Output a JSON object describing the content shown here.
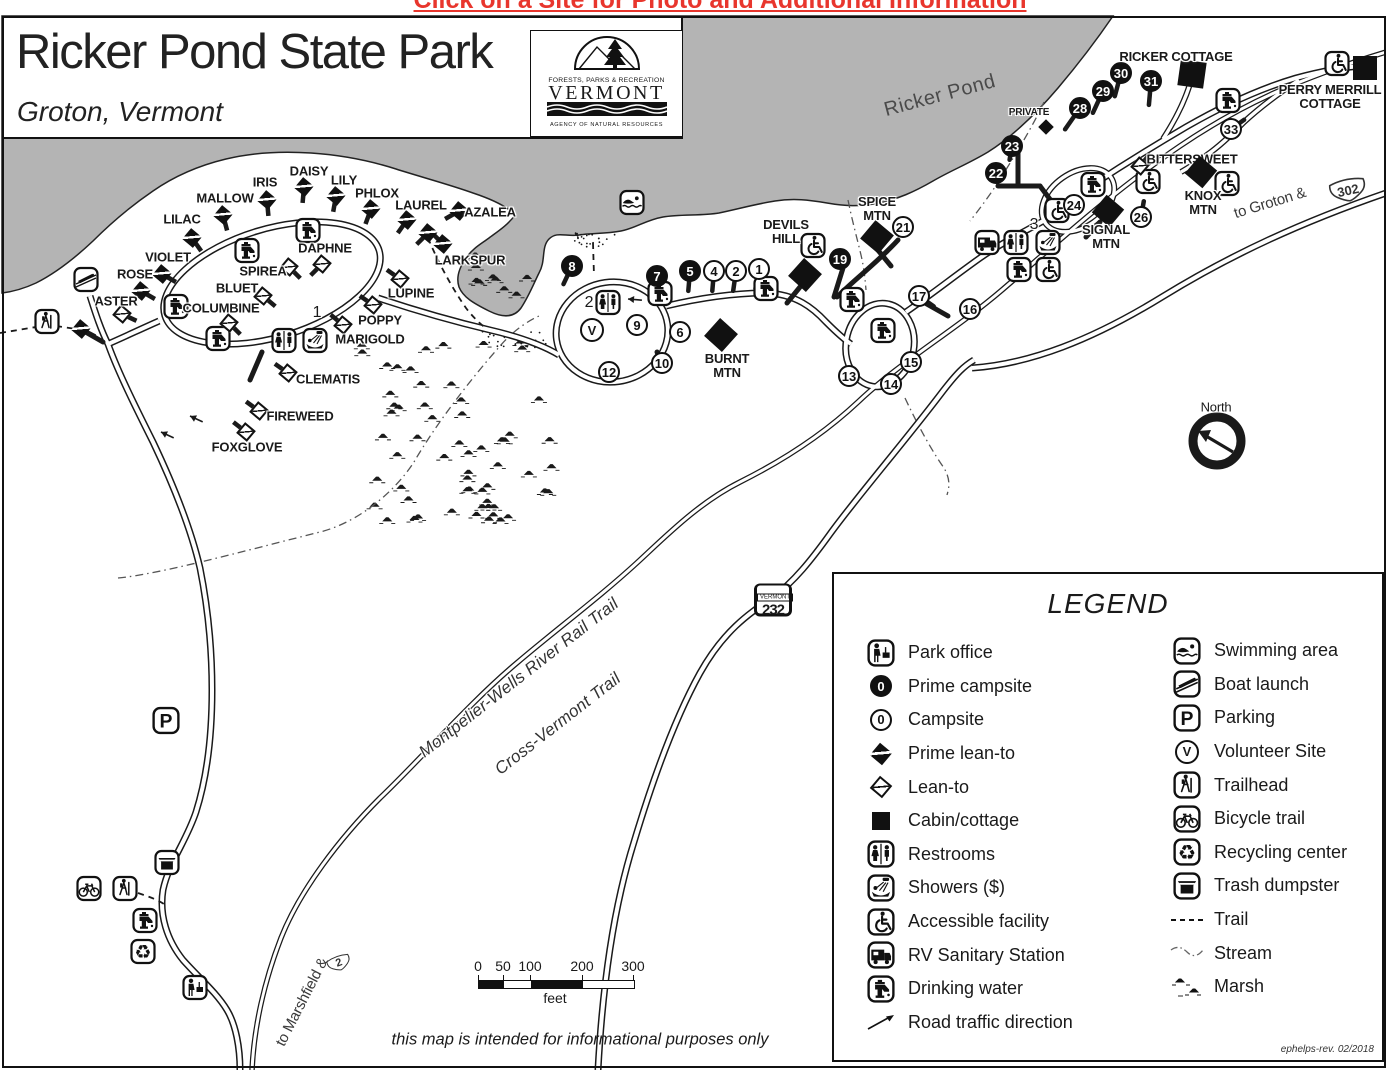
{
  "page": {
    "top_note": "Click on a Site for Photo and Additional Information"
  },
  "title_block": {
    "title": "Ricker Pond State Park",
    "subtitle": "Groton, Vermont",
    "logo": {
      "line1": "FORESTS, PARKS & RECREATION",
      "line2": "VERMONT",
      "line3": "AGENCY OF NATURAL RESOURCES"
    }
  },
  "map": {
    "water_label": "Ricker Pond",
    "north_label": "North",
    "trail_labels": [
      {
        "text": "Montpelier-Wells River Rail Trail",
        "x": 519,
        "y": 678,
        "rot": -38
      },
      {
        "text": "Cross-Vermont Trail",
        "x": 558,
        "y": 724,
        "rot": -38
      }
    ],
    "road_labels": [
      {
        "text": "to Groton &",
        "x": 1270,
        "y": 203,
        "rot": -17
      },
      {
        "text": "to Marshfield &",
        "x": 302,
        "y": 1002,
        "rot": -63
      }
    ],
    "shields": [
      {
        "kind": "vt",
        "topline": "VERMONT",
        "num": "232",
        "x": 773,
        "y": 600,
        "rot": 0
      },
      {
        "kind": "us",
        "num": "302",
        "x": 1348,
        "y": 190,
        "rot": -12
      },
      {
        "kind": "us",
        "num": "2",
        "x": 339,
        "y": 963,
        "rot": -20
      }
    ],
    "campsites": [
      {
        "n": "1",
        "x": 759,
        "y": 269,
        "prime": false
      },
      {
        "n": "2",
        "x": 736,
        "y": 271,
        "prime": false
      },
      {
        "n": "4",
        "x": 714,
        "y": 271,
        "prime": false
      },
      {
        "n": "5",
        "x": 690,
        "y": 271,
        "prime": true
      },
      {
        "n": "7",
        "x": 657,
        "y": 276,
        "prime": true
      },
      {
        "n": "8",
        "x": 572,
        "y": 266,
        "prime": true
      },
      {
        "n": "6",
        "x": 680,
        "y": 332,
        "prime": false
      },
      {
        "n": "9",
        "x": 637,
        "y": 325,
        "prime": false
      },
      {
        "n": "10",
        "x": 662,
        "y": 363,
        "prime": false
      },
      {
        "n": "12",
        "x": 609,
        "y": 372,
        "prime": false
      },
      {
        "n": "13",
        "x": 849,
        "y": 376,
        "prime": false
      },
      {
        "n": "14",
        "x": 891,
        "y": 384,
        "prime": false
      },
      {
        "n": "15",
        "x": 911,
        "y": 362,
        "prime": false
      },
      {
        "n": "16",
        "x": 970,
        "y": 309,
        "prime": false
      },
      {
        "n": "17",
        "x": 919,
        "y": 296,
        "prime": false
      },
      {
        "n": "19",
        "x": 840,
        "y": 259,
        "prime": true
      },
      {
        "n": "21",
        "x": 903,
        "y": 227,
        "prime": false
      },
      {
        "n": "22",
        "x": 996,
        "y": 173,
        "prime": true
      },
      {
        "n": "23",
        "x": 1012,
        "y": 146,
        "prime": true
      },
      {
        "n": "24",
        "x": 1074,
        "y": 205,
        "prime": false
      },
      {
        "n": "26",
        "x": 1141,
        "y": 217,
        "prime": false
      },
      {
        "n": "28",
        "x": 1080,
        "y": 108,
        "prime": true
      },
      {
        "n": "29",
        "x": 1103,
        "y": 91,
        "prime": true
      },
      {
        "n": "30",
        "x": 1121,
        "y": 73,
        "prime": true
      },
      {
        "n": "31",
        "x": 1151,
        "y": 81,
        "prime": true
      },
      {
        "n": "33",
        "x": 1231,
        "y": 129,
        "prime": false
      }
    ],
    "area_labels": [
      {
        "text": "1",
        "x": 317,
        "y": 313
      },
      {
        "text": "2",
        "x": 589,
        "y": 303
      },
      {
        "text": "3",
        "x": 1034,
        "y": 225
      }
    ],
    "leantos": [
      {
        "name": "LILAC",
        "ix": 192,
        "iy": 238,
        "lx": 182,
        "ly": 219,
        "prime": true,
        "spur": 55
      },
      {
        "name": "MALLOW",
        "ix": 223,
        "iy": 215,
        "lx": 225,
        "ly": 198,
        "prime": true,
        "spur": 75
      },
      {
        "name": "IRIS",
        "ix": 267,
        "iy": 200,
        "lx": 265,
        "ly": 182,
        "prime": true,
        "spur": 85
      },
      {
        "name": "DAISY",
        "ix": 304,
        "iy": 187,
        "lx": 309,
        "ly": 171,
        "prime": true,
        "spur": 95
      },
      {
        "name": "LILY",
        "ix": 336,
        "iy": 196,
        "lx": 344,
        "ly": 180,
        "prime": true,
        "spur": 100
      },
      {
        "name": "PHLOX",
        "ix": 371,
        "iy": 209,
        "lx": 377,
        "ly": 193,
        "prime": true,
        "spur": 110
      },
      {
        "name": "LAUREL",
        "ix": 407,
        "iy": 220,
        "lx": 421,
        "ly": 205,
        "prime": true,
        "spur": 125
      },
      {
        "name": "",
        "ix": 428,
        "iy": 233,
        "lx": 0,
        "ly": 0,
        "prime": true,
        "spur": 135
      },
      {
        "name": "AZALEA",
        "ix": 459,
        "iy": 211,
        "lx": 490,
        "ly": 212,
        "prime": true,
        "spur": 150
      },
      {
        "name": "LARKSPUR",
        "ix": 443,
        "iy": 244,
        "lx": 470,
        "ly": 260,
        "prime": true,
        "spur": 225
      },
      {
        "name": "VIOLET",
        "ix": 162,
        "iy": 274,
        "lx": 168,
        "ly": 257,
        "prime": true,
        "spur": 30
      },
      {
        "name": "ROSE",
        "ix": 141,
        "iy": 291,
        "lx": 135,
        "ly": 274,
        "prime": true,
        "spur": 30
      },
      {
        "name": "ASTER",
        "ix": 122,
        "iy": 314,
        "lx": 116,
        "ly": 301,
        "prime": false,
        "spur": 25
      },
      {
        "name": "",
        "ix": 81,
        "iy": 329,
        "lx": 0,
        "ly": 0,
        "prime": true,
        "spur": 28
      },
      {
        "name": "DAPHNE",
        "ix": 322,
        "iy": 264,
        "lx": 325,
        "ly": 248,
        "prime": false,
        "spur": 135
      },
      {
        "name": "SPIREA",
        "ix": 289,
        "iy": 267,
        "lx": 263,
        "ly": 271,
        "prime": false,
        "spur": 45
      },
      {
        "name": "BLUET",
        "ix": 263,
        "iy": 296,
        "lx": 237,
        "ly": 288,
        "prime": false,
        "spur": 40
      },
      {
        "name": "COLUMBINE",
        "ix": 229,
        "iy": 323,
        "lx": 221,
        "ly": 308,
        "prime": false,
        "spur": 45
      },
      {
        "name": "LUPINE",
        "ix": 400,
        "iy": 279,
        "lx": 411,
        "ly": 293,
        "prime": false,
        "spur": 215
      },
      {
        "name": "POPPY",
        "ix": 373,
        "iy": 305,
        "lx": 380,
        "ly": 320,
        "prime": false,
        "spur": 215
      },
      {
        "name": "MARIGOLD",
        "ix": 343,
        "iy": 325,
        "lx": 370,
        "ly": 339,
        "prime": false,
        "spur": 220
      },
      {
        "name": "CLEMATIS",
        "ix": 288,
        "iy": 373,
        "lx": 328,
        "ly": 379,
        "prime": false,
        "spur": 215
      },
      {
        "name": "FIREWEED",
        "ix": 259,
        "iy": 411,
        "lx": 300,
        "ly": 416,
        "prime": false,
        "spur": 216
      },
      {
        "name": "FOXGLOVE",
        "ix": 246,
        "iy": 432,
        "lx": 247,
        "ly": 447,
        "prime": false,
        "spur": 218
      },
      {
        "name": "BITTERSWEET",
        "ix": 1140,
        "iy": 166,
        "lx": 1192,
        "ly": 159,
        "prime": false,
        "spur": 310
      }
    ],
    "cabins": [
      {
        "name": "RICKER COTTAGE",
        "lines": [
          "RICKER COTTAGE"
        ],
        "sx": 1192,
        "sy": 74,
        "size": 26,
        "rot": 8,
        "lx": 1176,
        "ly": 57
      },
      {
        "name": "PERRY MERRILL COTTAGE",
        "lines": [
          "PERRY MERRILL",
          "COTTAGE"
        ],
        "sx": 1365,
        "sy": 68,
        "size": 24,
        "rot": 0,
        "lx": 1330,
        "ly": 97
      },
      {
        "name": "PRIVATE",
        "lines": [
          "PRIVATE"
        ],
        "sx": 1046,
        "sy": 127,
        "size": 11,
        "rot": 45,
        "lx": 1029,
        "ly": 113,
        "small": true
      },
      {
        "name": "DEVILS HILL",
        "lines": [
          "DEVILS",
          "HILL"
        ],
        "sx": 805,
        "sy": 275,
        "size": 24,
        "rot": 42,
        "lx": 786,
        "ly": 232
      },
      {
        "name": "SPICE MTN",
        "lines": [
          "SPICE",
          "MTN"
        ],
        "sx": 877,
        "sy": 237,
        "size": 24,
        "rot": 40,
        "lx": 877,
        "ly": 209
      },
      {
        "name": "BURNT MTN",
        "lines": [
          "BURNT",
          "MTN"
        ],
        "sx": 721,
        "sy": 335,
        "size": 24,
        "rot": 42,
        "lx": 727,
        "ly": 366
      },
      {
        "name": "SIGNAL MTN",
        "lines": [
          "SIGNAL",
          "MTN"
        ],
        "sx": 1108,
        "sy": 211,
        "size": 23,
        "rot": 40,
        "lx": 1106,
        "ly": 237
      },
      {
        "name": "KNOX MTN",
        "lines": [
          "KNOX",
          "MTN"
        ],
        "sx": 1201,
        "sy": 172,
        "size": 23,
        "rot": 40,
        "lx": 1203,
        "ly": 203
      }
    ],
    "facilities": [
      {
        "type": "water",
        "x": 308,
        "y": 233
      },
      {
        "type": "water",
        "x": 247,
        "y": 253
      },
      {
        "type": "water",
        "x": 176,
        "y": 309
      },
      {
        "type": "water",
        "x": 218,
        "y": 341
      },
      {
        "type": "water",
        "x": 660,
        "y": 296
      },
      {
        "type": "water",
        "x": 766,
        "y": 291
      },
      {
        "type": "water",
        "x": 852,
        "y": 302
      },
      {
        "type": "water",
        "x": 883,
        "y": 333
      },
      {
        "type": "water",
        "x": 1019,
        "y": 272
      },
      {
        "type": "water",
        "x": 1093,
        "y": 187
      },
      {
        "type": "water",
        "x": 1228,
        "y": 103
      },
      {
        "type": "water",
        "x": 145,
        "y": 923
      },
      {
        "type": "restrooms",
        "x": 284,
        "y": 343
      },
      {
        "type": "restrooms",
        "x": 608,
        "y": 305
      },
      {
        "type": "restrooms",
        "x": 1016,
        "y": 245
      },
      {
        "type": "showers",
        "x": 315,
        "y": 343
      },
      {
        "type": "showers",
        "x": 1048,
        "y": 245
      },
      {
        "type": "rv",
        "x": 987,
        "y": 245
      },
      {
        "type": "accessible",
        "x": 813,
        "y": 248
      },
      {
        "type": "accessible",
        "x": 1048,
        "y": 272
      },
      {
        "type": "accessible",
        "x": 1057,
        "y": 213
      },
      {
        "type": "accessible",
        "x": 1148,
        "y": 184
      },
      {
        "type": "accessible",
        "x": 1227,
        "y": 186
      },
      {
        "type": "accessible",
        "x": 1337,
        "y": 66
      },
      {
        "type": "swim",
        "x": 632,
        "y": 205
      },
      {
        "type": "boat",
        "x": 86,
        "y": 282
      },
      {
        "type": "trailhead",
        "x": 47,
        "y": 324
      },
      {
        "type": "trailhead",
        "x": 125,
        "y": 891
      },
      {
        "type": "bicycle",
        "x": 89,
        "y": 891
      },
      {
        "type": "parking",
        "x": 166,
        "y": 723
      },
      {
        "type": "trash",
        "x": 167,
        "y": 865
      },
      {
        "type": "recycle",
        "x": 143,
        "y": 954
      },
      {
        "type": "parkoffice",
        "x": 195,
        "y": 990
      },
      {
        "type": "volunteer",
        "x": 592,
        "y": 330
      }
    ]
  },
  "legend": {
    "title": "LEGEND",
    "left": [
      {
        "icon": "parkoffice",
        "label": "Park office"
      },
      {
        "icon": "primecirc",
        "label": "Prime campsite"
      },
      {
        "icon": "opencirc",
        "label": "Campsite"
      },
      {
        "icon": "primeleanto",
        "label": "Prime lean-to"
      },
      {
        "icon": "leanto",
        "label": "Lean-to"
      },
      {
        "icon": "cabin",
        "label": "Cabin/cottage"
      },
      {
        "icon": "restrooms",
        "label": "Restrooms"
      },
      {
        "icon": "showers",
        "label": "Showers ($)"
      },
      {
        "icon": "accessible",
        "label": "Accessible facility"
      },
      {
        "icon": "rv",
        "label": "RV Sanitary Station"
      },
      {
        "icon": "water",
        "label": "Drinking water"
      },
      {
        "icon": "roadarrow",
        "label": "Road traffic direction"
      }
    ],
    "right": [
      {
        "icon": "swim",
        "label": "Swimming area"
      },
      {
        "icon": "boat",
        "label": "Boat launch"
      },
      {
        "icon": "parking",
        "label": "Parking"
      },
      {
        "icon": "volunteer",
        "label": "Volunteer Site"
      },
      {
        "icon": "trailhead",
        "label": "Trailhead"
      },
      {
        "icon": "bicycle",
        "label": "Bicycle trail"
      },
      {
        "icon": "recycle",
        "label": "Recycling center"
      },
      {
        "icon": "trash",
        "label": "Trash dumpster"
      },
      {
        "icon": "trail",
        "label": "Trail"
      },
      {
        "icon": "stream",
        "label": "Stream"
      },
      {
        "icon": "marsh",
        "label": "Marsh"
      }
    ],
    "credit": "ephelps-rev. 02/2018"
  },
  "scale": {
    "ticks": [
      "0",
      "50",
      "100",
      "200",
      "300"
    ],
    "unit": "feet"
  },
  "footer_note": "this map is intended for informational purposes only",
  "colors": {
    "water": "#b4b4b4",
    "ink": "#1a1a1a",
    "red": "#e8362d"
  }
}
